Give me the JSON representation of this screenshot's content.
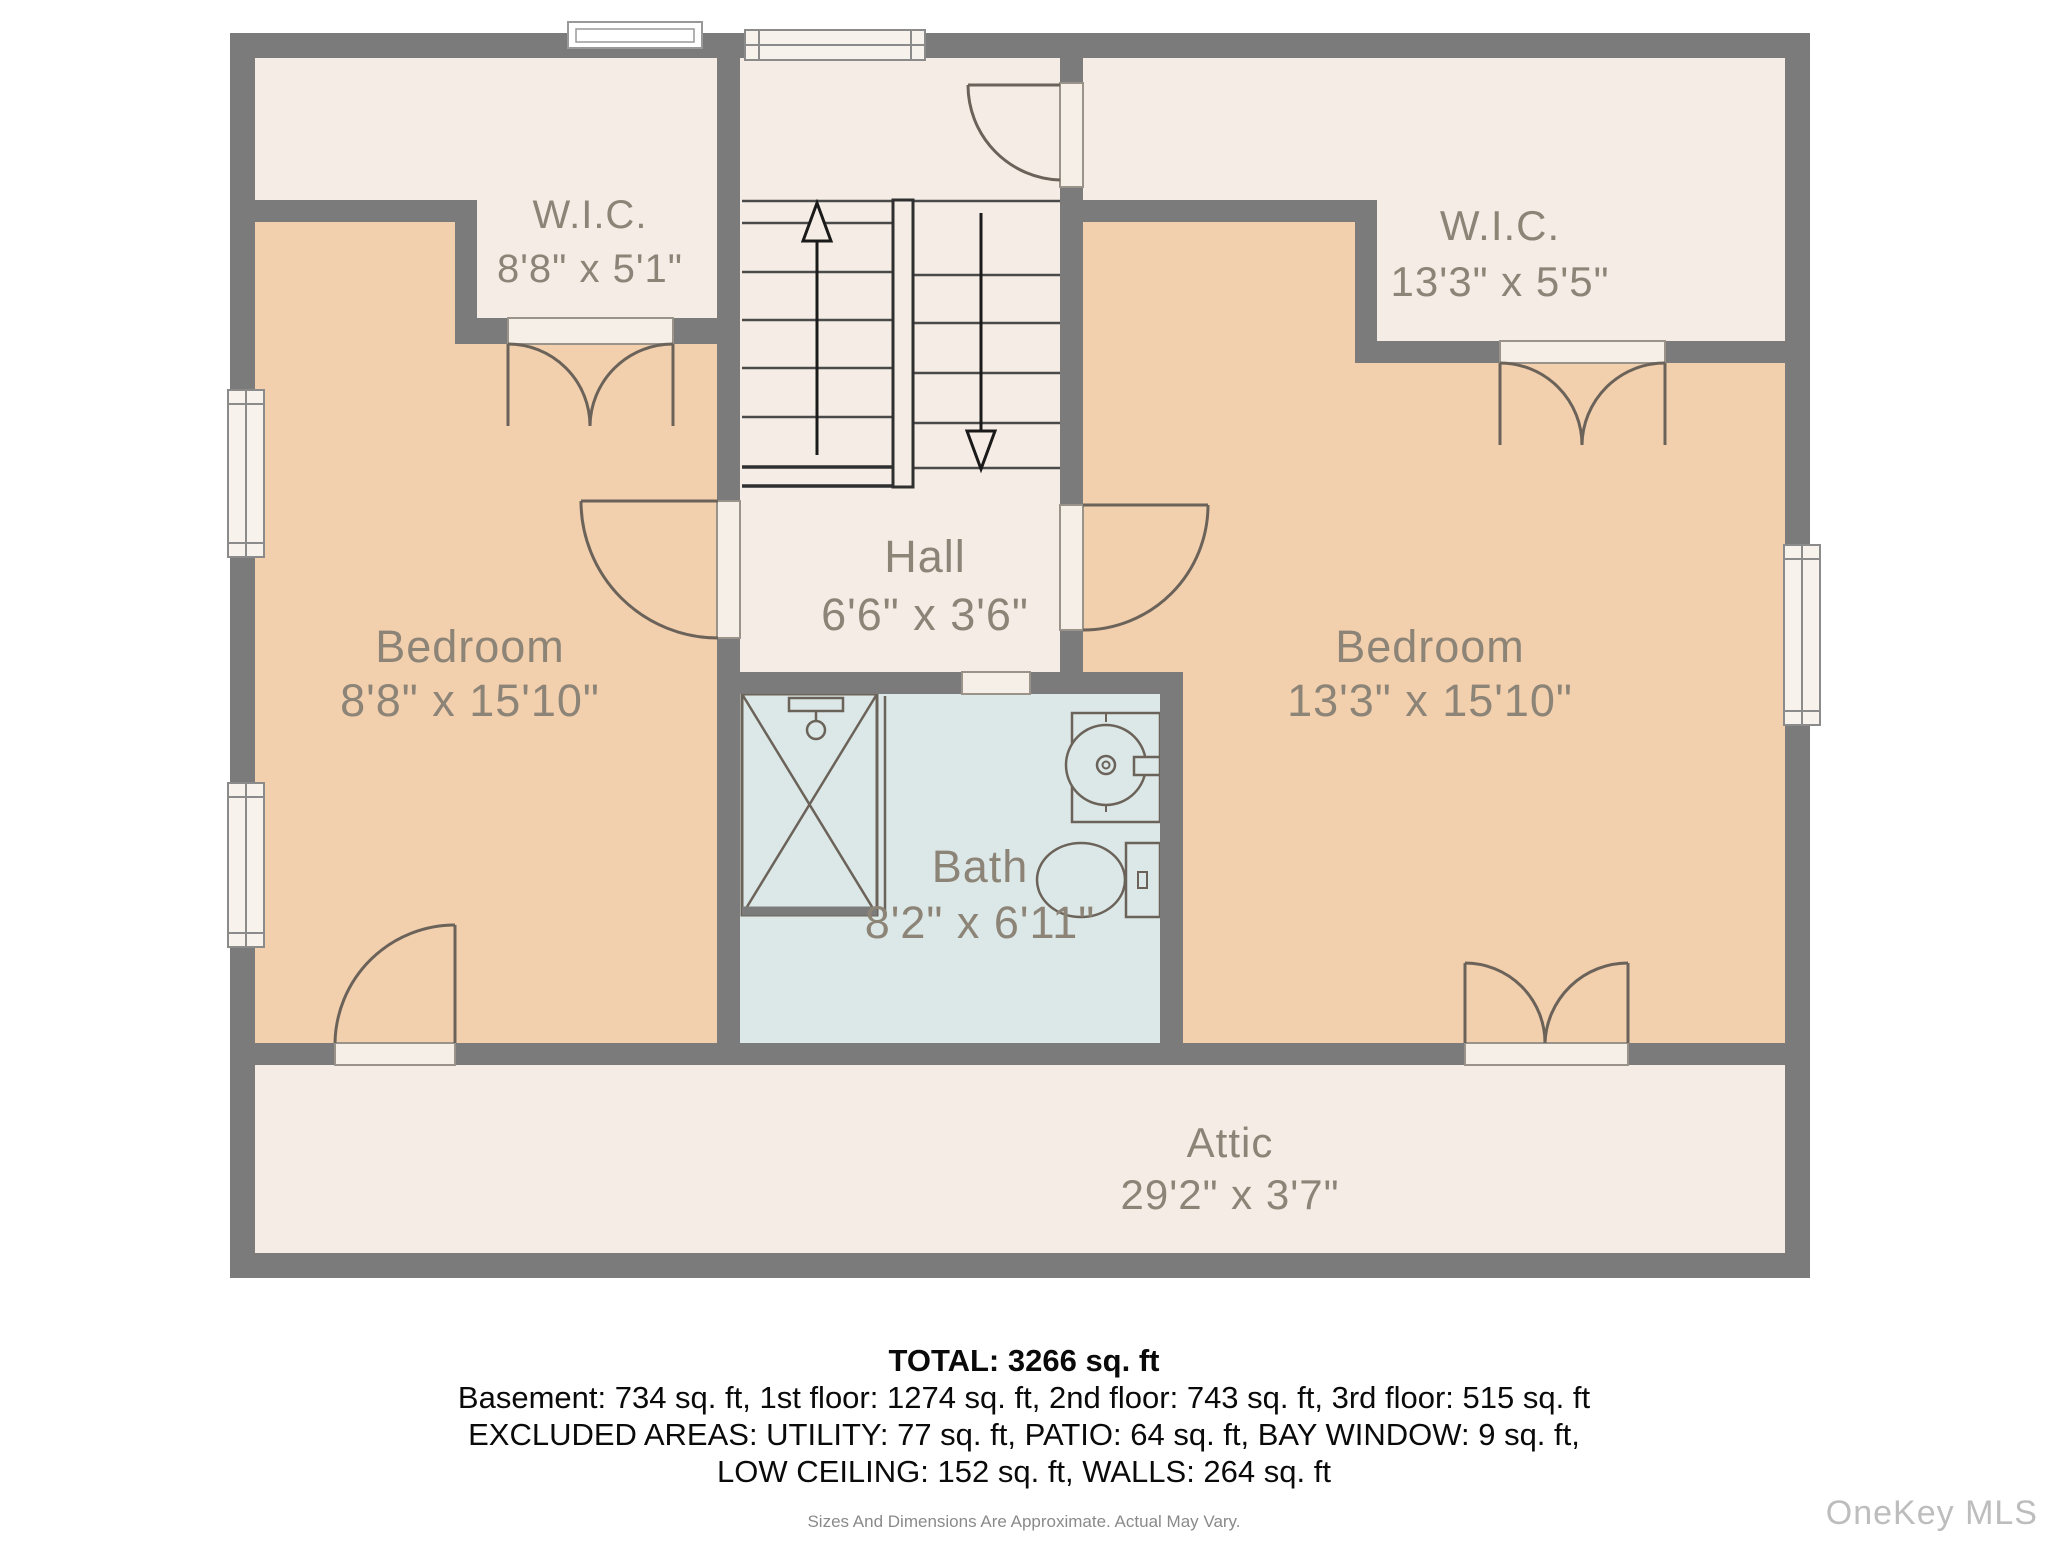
{
  "plan": {
    "rooms": {
      "wic_left": {
        "name": "W.I.C.",
        "dims": "8'8\" x 5'1\""
      },
      "bedroom_left": {
        "name": "Bedroom",
        "dims": "8'8\" x 15'10\""
      },
      "hall": {
        "name": "Hall",
        "dims": "6'6\" x 3'6\""
      },
      "wic_right": {
        "name": "W.I.C.",
        "dims": "13'3\" x 5'5\""
      },
      "bedroom_right": {
        "name": "Bedroom",
        "dims": "13'3\" x 15'10\""
      },
      "bath": {
        "name": "Bath",
        "dims": "8'2\" x 6'11\""
      },
      "attic": {
        "name": "Attic",
        "dims": "29'2\" x 3'7\""
      }
    },
    "icons": {
      "stairs_up": "up-arrow",
      "stairs_down": "down-arrow"
    },
    "colors": {
      "wall": "#7b7b7b",
      "room_cream": "#f5ede5",
      "room_peach": "#f2cfad",
      "room_bath": "#dce8e7",
      "label_text": "#8d8478",
      "fixture_line": "#6b635a"
    }
  },
  "footer": {
    "total": "TOTAL: 3266 sq. ft",
    "floors": "Basement: 734 sq. ft, 1st floor: 1274 sq. ft, 2nd floor: 743 sq. ft, 3rd floor: 515 sq. ft",
    "excluded_line1": "EXCLUDED AREAS: UTILITY: 77 sq. ft, PATIO: 64 sq. ft, BAY WINDOW: 9 sq. ft,",
    "excluded_line2": "LOW CEILING: 152 sq. ft, WALLS: 264 sq. ft",
    "disclaimer": "Sizes And Dimensions Are Approximate. Actual May Vary.",
    "watermark": "OneKey MLS"
  }
}
